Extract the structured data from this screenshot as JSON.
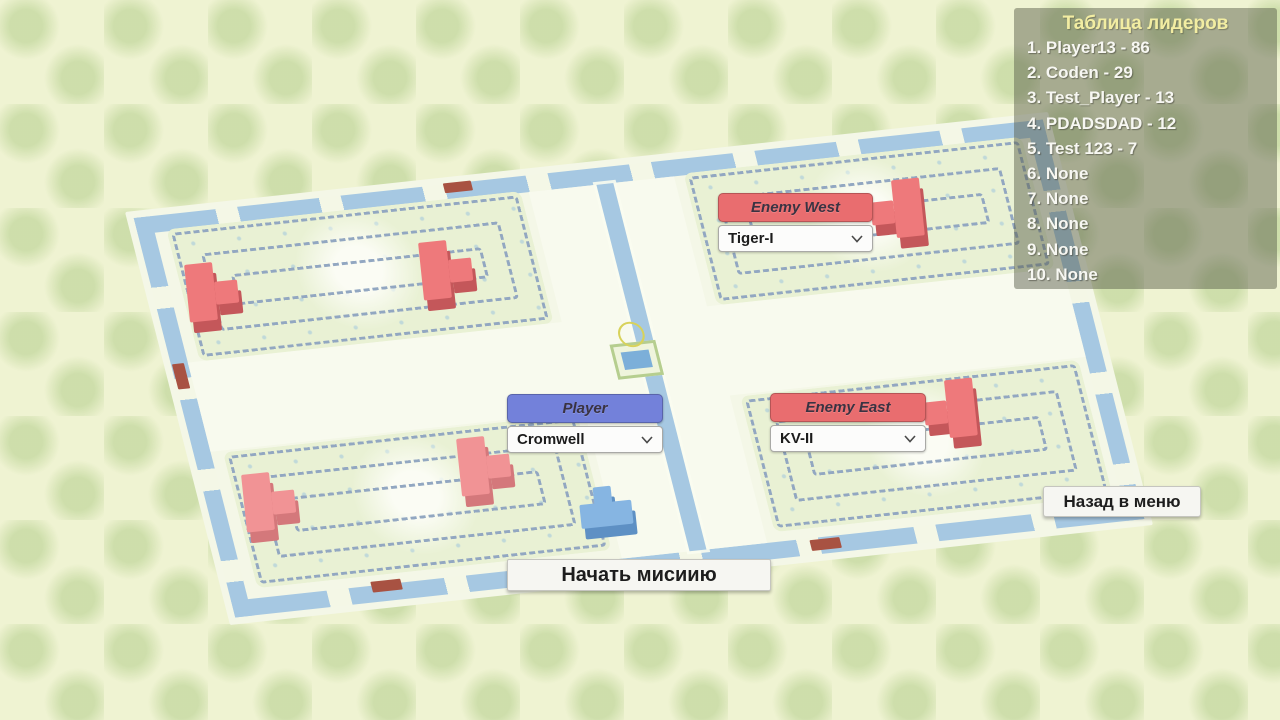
{
  "leaderboard": {
    "title": "Таблица лидеров",
    "entries": [
      "1. Player13 - 86",
      "2. Coden - 29",
      "3. Test_Player - 13",
      "4. PDADSDAD - 12",
      "5. Test 123 - 7",
      "6. None",
      "7. None",
      "8. None",
      "9. None",
      "10. None"
    ]
  },
  "panels": {
    "enemy_west": {
      "label": "Enemy West",
      "selected": "Tiger-I"
    },
    "player": {
      "label": "Player",
      "selected": "Cromwell"
    },
    "enemy_east": {
      "label": "Enemy East",
      "selected": "KV-II"
    }
  },
  "buttons": {
    "back_to_menu": "Назад в меню",
    "start_mission": "Начать мисиию"
  },
  "colors": {
    "red_header": "#e96d6f",
    "blue_header": "#7381da",
    "canal_blue": "#a6c8e2",
    "maze_wall": "#92a7c1",
    "leaderboard_title": "#f2eda2",
    "leaderboard_text": "#f7f7f2",
    "enemy_tank_top": "#ee797b",
    "enemy_tank_side": "#c4575a",
    "enemy_light_top": "#f19395",
    "enemy_light_side": "#d4787b",
    "player_tank_top": "#86b5e2",
    "player_tank_side": "#5e90c4"
  },
  "map": {
    "units": [
      {
        "name": "enemy-tank-west-wall",
        "x": 186,
        "y": 260,
        "stem": "right",
        "palette": "enemy"
      },
      {
        "name": "enemy-tank-northwest",
        "x": 420,
        "y": 238,
        "stem": "right",
        "palette": "enemy"
      },
      {
        "name": "enemy-tank-center",
        "x": 458,
        "y": 434,
        "stem": "right",
        "palette": "enemy-light"
      },
      {
        "name": "enemy-tank-southwest",
        "x": 243,
        "y": 470,
        "stem": "right",
        "palette": "enemy-light"
      },
      {
        "name": "enemy-tank-northeast",
        "x": 869,
        "y": 178,
        "stem": "left",
        "palette": "enemy"
      },
      {
        "name": "enemy-tank-east",
        "x": 922,
        "y": 378,
        "stem": "left",
        "palette": "enemy"
      },
      {
        "name": "player-tank",
        "x": 578,
        "y": 484,
        "stem": "up",
        "palette": "player"
      }
    ]
  }
}
